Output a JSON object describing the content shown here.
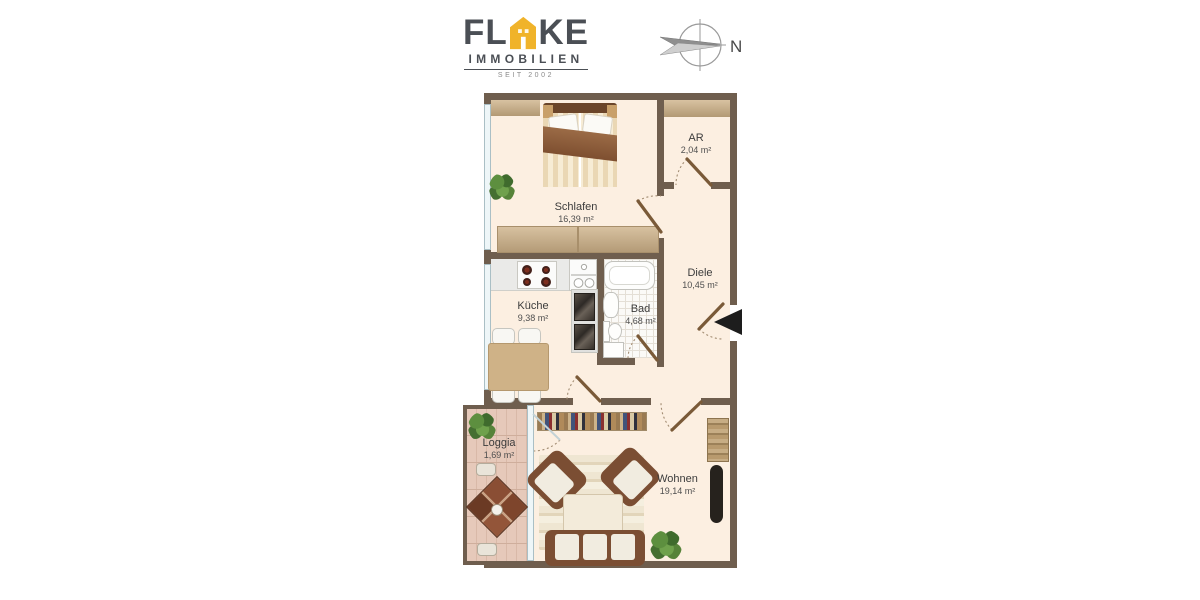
{
  "header": {
    "logo": {
      "name_part1": "FL",
      "name_part2": "KE",
      "subtitle": "IMMOBILIEN",
      "tagline": "SEIT 2002"
    },
    "compass_label": "N"
  },
  "floorplan": {
    "rooms": [
      {
        "name": "Schlafen",
        "area": "16,39 m²"
      },
      {
        "name": "AR",
        "area": "2,04 m²"
      },
      {
        "name": "Diele",
        "area": "10,45 m²"
      },
      {
        "name": "Küche",
        "area": "9,38 m²"
      },
      {
        "name": "Bad",
        "area": "4,68 m²"
      },
      {
        "name": "Wohnen",
        "area": "19,14 m²"
      },
      {
        "name": "Loggia",
        "area": "1,69 m²"
      }
    ]
  },
  "colors": {
    "wall": "#6f5e4e",
    "floor": "#fcefe1",
    "loggia_floor": "#e6c9ba",
    "brand_yellow": "#f0b32a",
    "brand_gray": "#4b4f55"
  }
}
